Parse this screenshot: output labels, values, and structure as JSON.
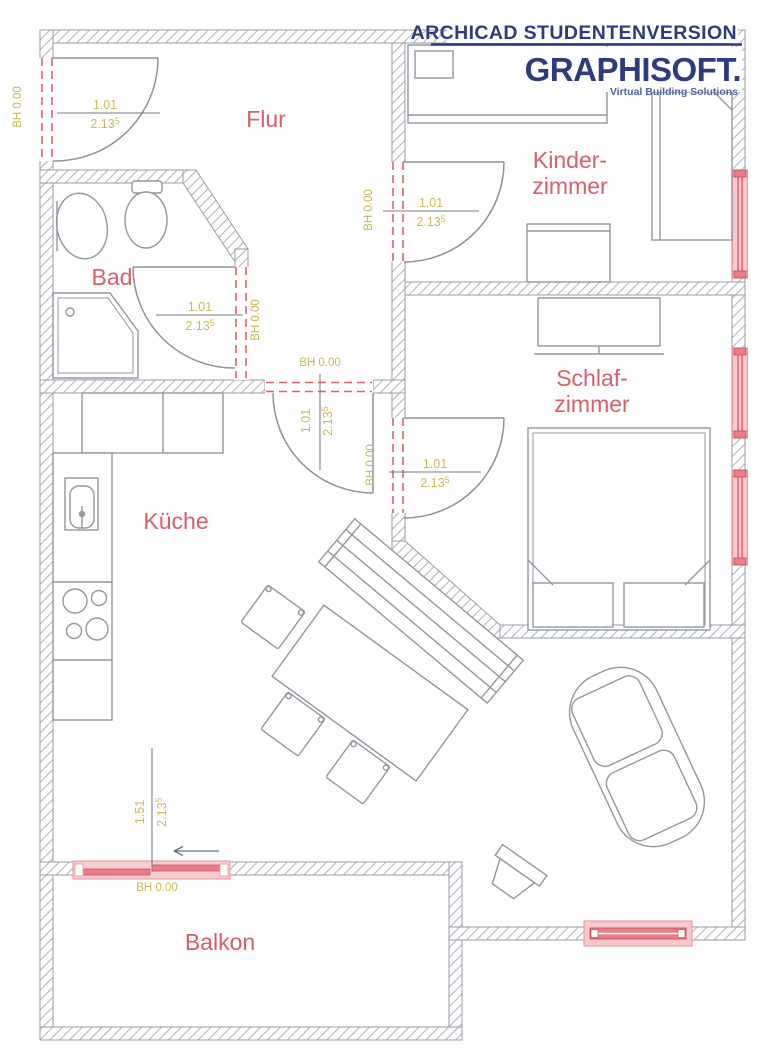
{
  "branding": {
    "line1": "ARCHICAD STUDENTENVERSION",
    "logo": "GRAPHISOFT.",
    "tagline": "Virtual Building Solutions"
  },
  "room_labels": {
    "flur": "Flur",
    "bad": "Bad",
    "kinder1": "Kinder-",
    "kinder2": "zimmer",
    "schlaf1": "Schlaf-",
    "schlaf2": "zimmer",
    "kueche": "Küche",
    "balkon": "Balkon"
  },
  "door_labels": {
    "entrance": {
      "w": "1.01",
      "h": "2.13",
      "sup": "5",
      "bh": "BH 0.00"
    },
    "bad": {
      "w": "1.01",
      "h": "2.13",
      "sup": "5",
      "bh": "BH 0.00"
    },
    "kinder": {
      "w": "1.01",
      "h": "2.13",
      "sup": "5",
      "bh": "BH 0.00"
    },
    "wohnen": {
      "w": "1.01",
      "h": "2.13",
      "sup": "5",
      "bh": "BH 0.00"
    },
    "schlaf": {
      "w": "1.01",
      "h": "2.13",
      "sup": "5",
      "bh": "BH 0.00"
    },
    "balkon": {
      "w": "1.51",
      "h": "2.13",
      "sup": "5",
      "bh": "BH 0.00"
    }
  },
  "colors": {
    "brand_navy": "#2e3c7e",
    "brand_navy_light": "#5261a0",
    "room_label_red": "#d4606c",
    "dimension_yellow": "#c9bb54",
    "opening_red": "#e0616b",
    "window_pink": "#ef9aa2",
    "wall_gray": "#9aa0a8"
  }
}
